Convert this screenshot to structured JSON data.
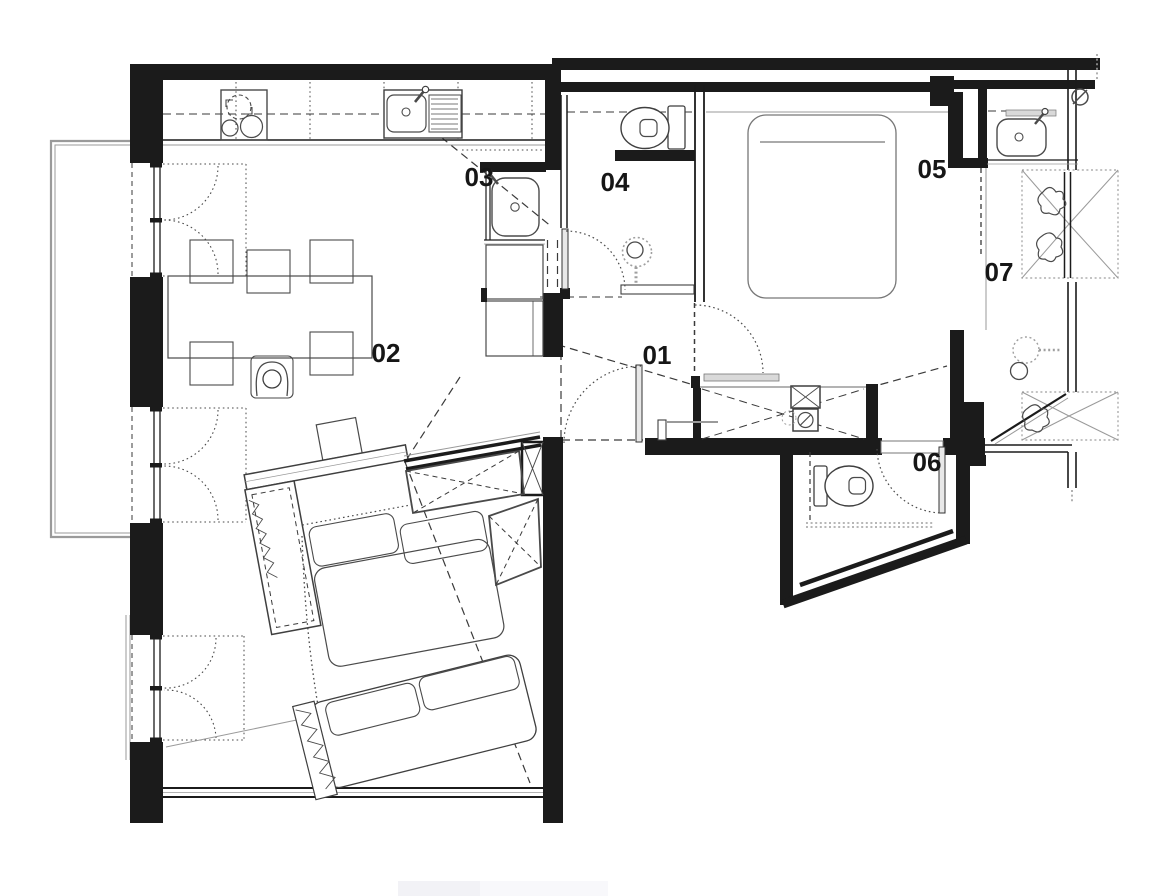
{
  "plan": {
    "background": "#ffffff",
    "wall_color": "#1b1b1b",
    "furniture_color": "#4a4a4a",
    "light_gray": "#9a9a9a",
    "rooms": [
      {
        "label": "01"
      },
      {
        "label": "02"
      },
      {
        "label": "03"
      },
      {
        "label": "04"
      },
      {
        "label": "05"
      },
      {
        "label": "06"
      },
      {
        "label": "07"
      }
    ],
    "fixtures": [
      "cooktop",
      "kitchen-sink",
      "washbasin",
      "dining-table",
      "chair",
      "person",
      "sofa-sectional",
      "sofa",
      "side-table",
      "tv-console",
      "duct-shaft",
      "double-bed",
      "toilet",
      "shower-head",
      "wardrobe",
      "washer-dryer-stack",
      "mirrored-closet",
      "ceiling-light",
      "valve",
      "balcony",
      "french-window",
      "door-swing"
    ]
  }
}
